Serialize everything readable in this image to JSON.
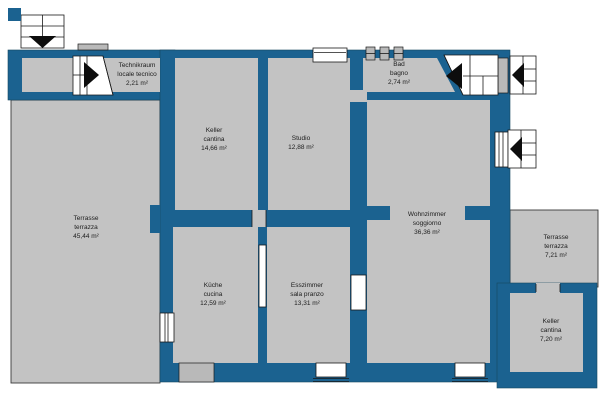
{
  "plan": {
    "type": "floor-plan",
    "languages": [
      "de",
      "it"
    ]
  },
  "colors": {
    "wall": "#1b6290",
    "room_fill": "#c3c3c3",
    "outline": "#1a1a1a",
    "background": "#ffffff",
    "stair_fill": "#ffffff"
  },
  "rooms": [
    {
      "id": "technikraum",
      "name_de": "Technikraum",
      "name_it": "locale tecnico",
      "area": "2,21 m²"
    },
    {
      "id": "keller_main",
      "name_de": "Keller",
      "name_it": "cantina",
      "area": "14,66 m²"
    },
    {
      "id": "studio",
      "name_de": "Studio",
      "name_it": "",
      "area": "12,88 m²"
    },
    {
      "id": "bad",
      "name_de": "Bad",
      "name_it": "bagno",
      "area": "2,74 m²"
    },
    {
      "id": "terrasse_west",
      "name_de": "Terrasse",
      "name_it": "terrazza",
      "area": "45,44 m²"
    },
    {
      "id": "kueche",
      "name_de": "Küche",
      "name_it": "cucina",
      "area": "12,59 m²"
    },
    {
      "id": "esszimmer",
      "name_de": "Esszimmer",
      "name_it": "sala pranzo",
      "area": "13,31 m²"
    },
    {
      "id": "wohnzimmer",
      "name_de": "Wohnzimmer",
      "name_it": "soggiorno",
      "area": "36,36 m²"
    },
    {
      "id": "terrasse_east",
      "name_de": "Terrasse",
      "name_it": "terrazza",
      "area": "7,21 m²"
    },
    {
      "id": "keller_east",
      "name_de": "Keller",
      "name_it": "cantina",
      "area": "7,20 m²"
    }
  ],
  "icons": {
    "entrance-arrow-icon": "▼",
    "stair-direction-right-icon": "▶",
    "stair-direction-left-icon": "◀",
    "window-well-icon": "◀ in gridded box",
    "vent-window-icon": "small gridded square"
  }
}
